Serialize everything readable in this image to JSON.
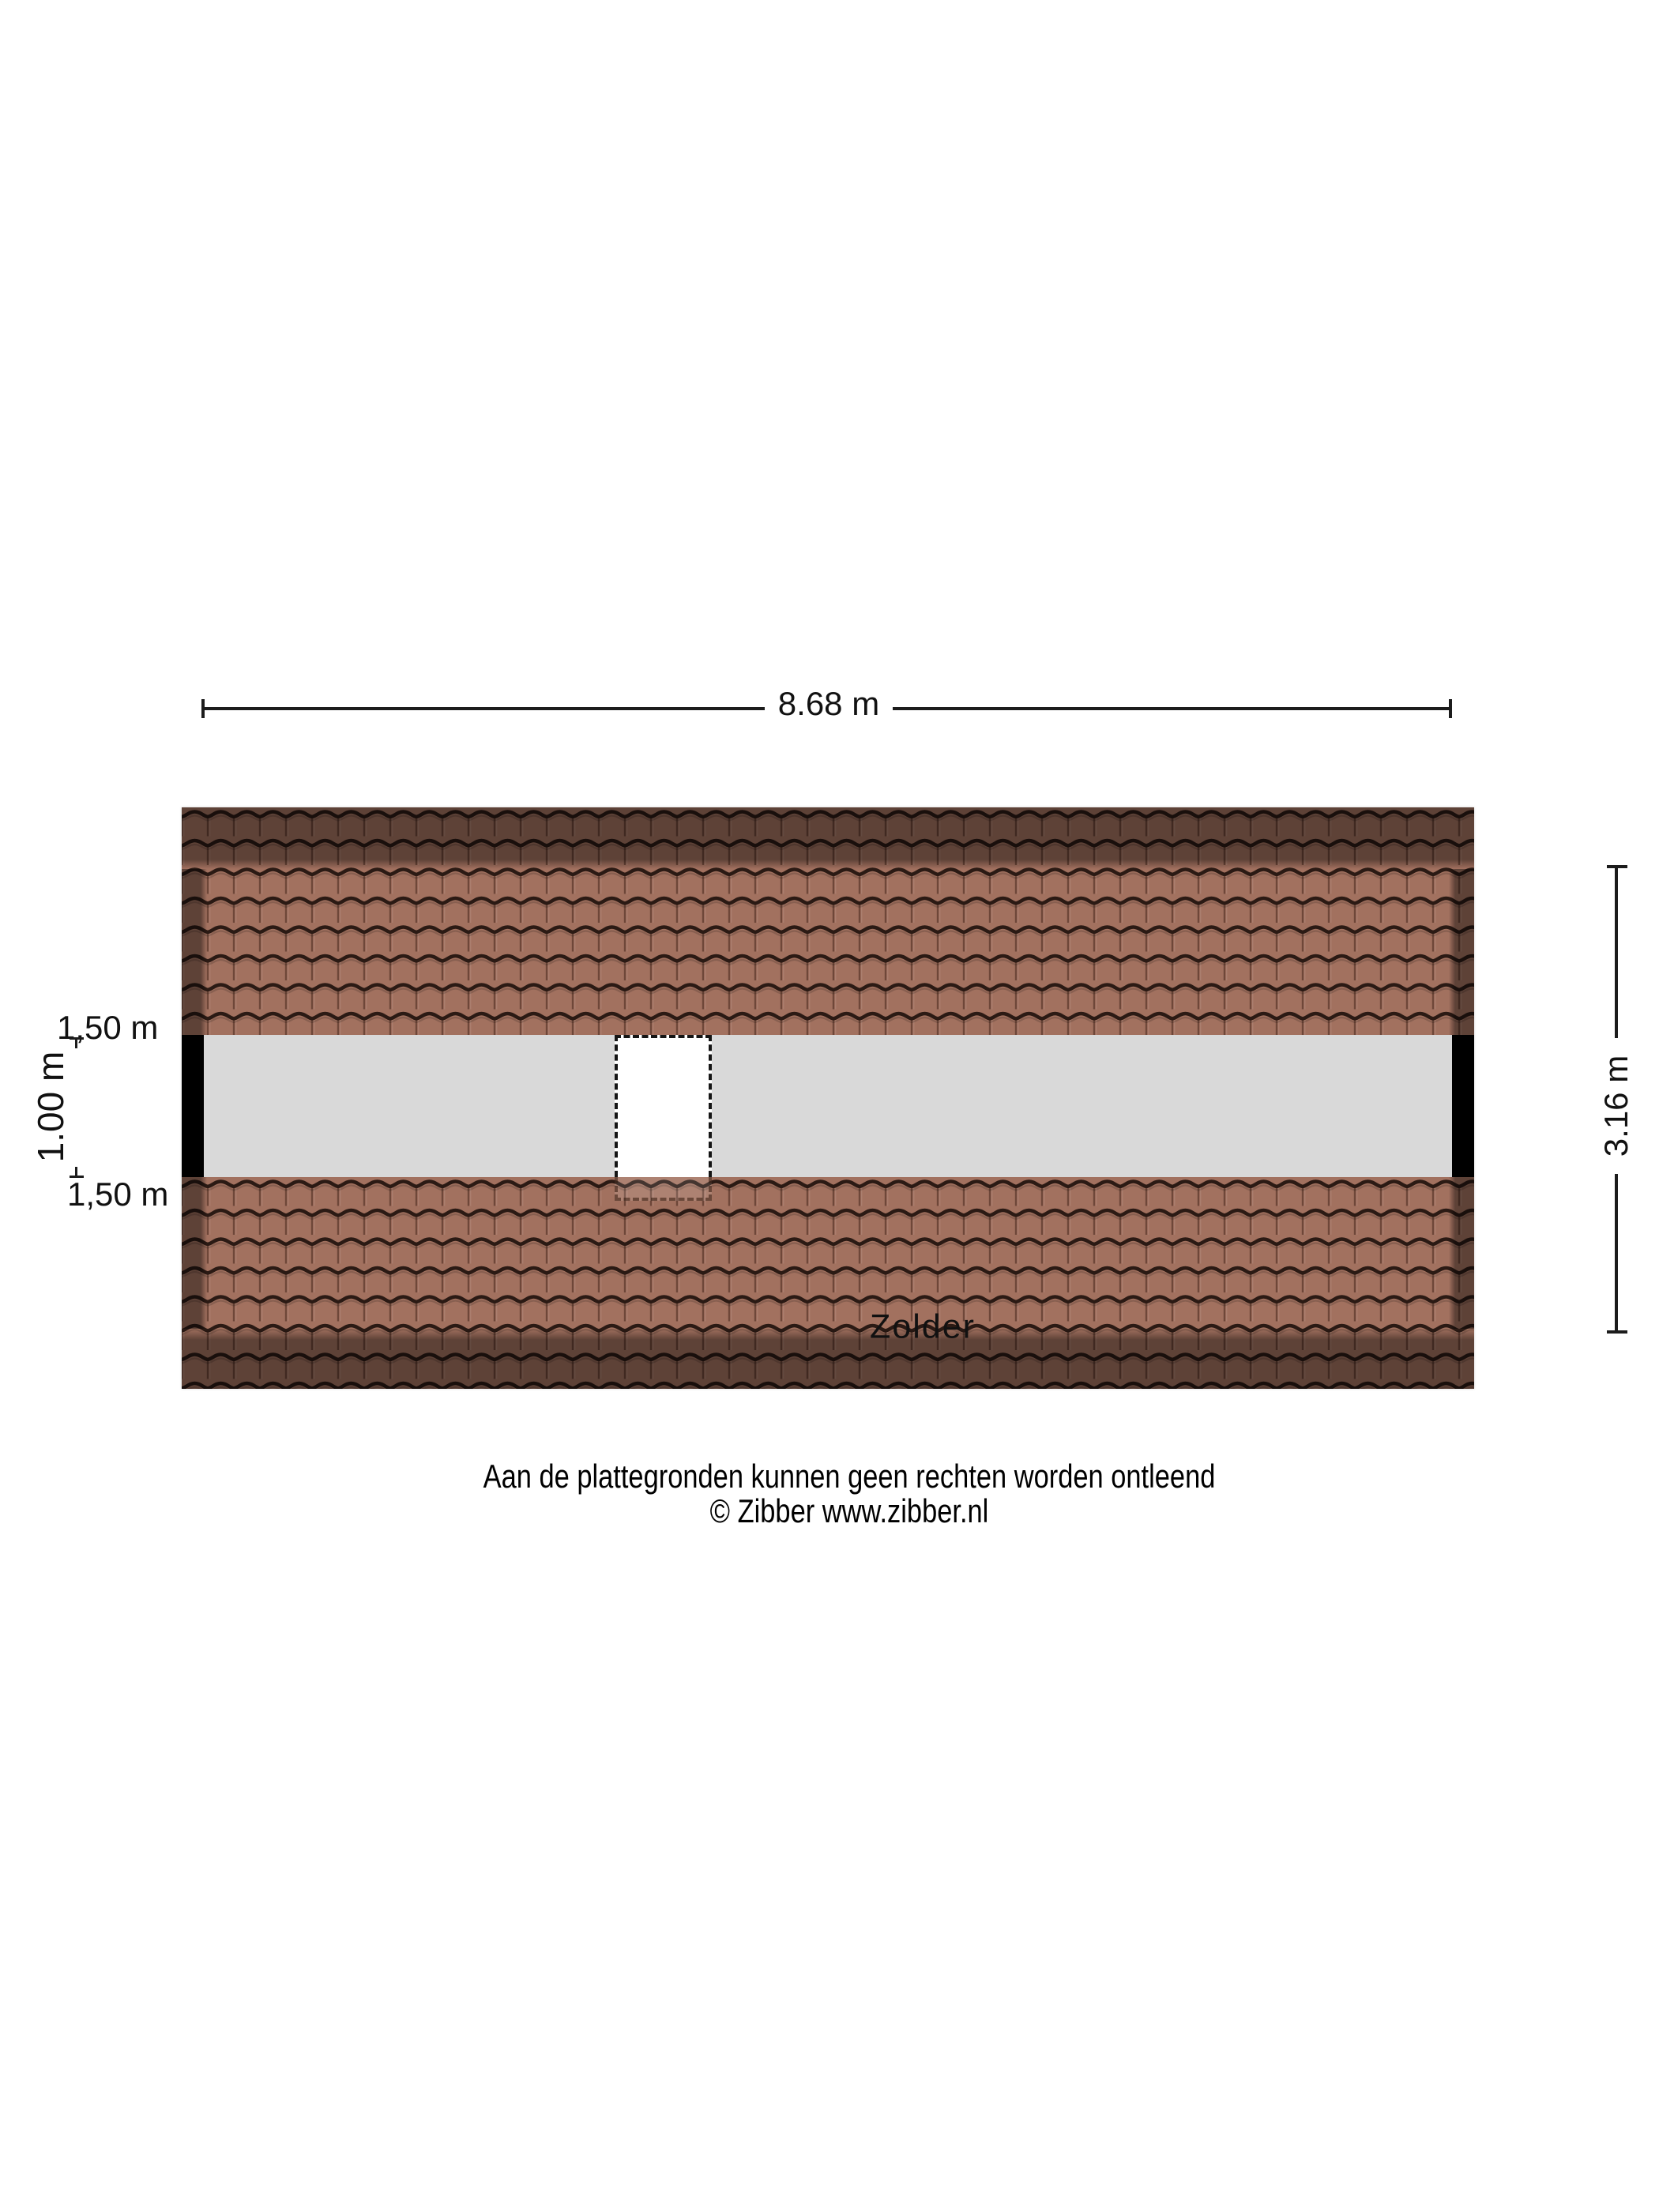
{
  "plan": {
    "room_label": "Zolder",
    "dimensions": {
      "width_total": "8.68 m",
      "depth_total": "3.16 m",
      "ridge_height_span": "1.00 m",
      "knee_wall_top": "1,50 m",
      "knee_wall_bottom": "1,50 m"
    },
    "colors": {
      "tile": "#a2715f",
      "tile_line": "#2b1a14",
      "roof_shadow": "rgba(0,0,0,0.42)",
      "floor": "#d9d9d9",
      "wall": "#000000",
      "dim": "#1c1c1c",
      "text": "#111111"
    }
  },
  "footer": {
    "disclaimer": "Aan de plattegronden kunnen geen rechten worden ontleend",
    "copyright": "© Zibber www.zibber.nl"
  }
}
